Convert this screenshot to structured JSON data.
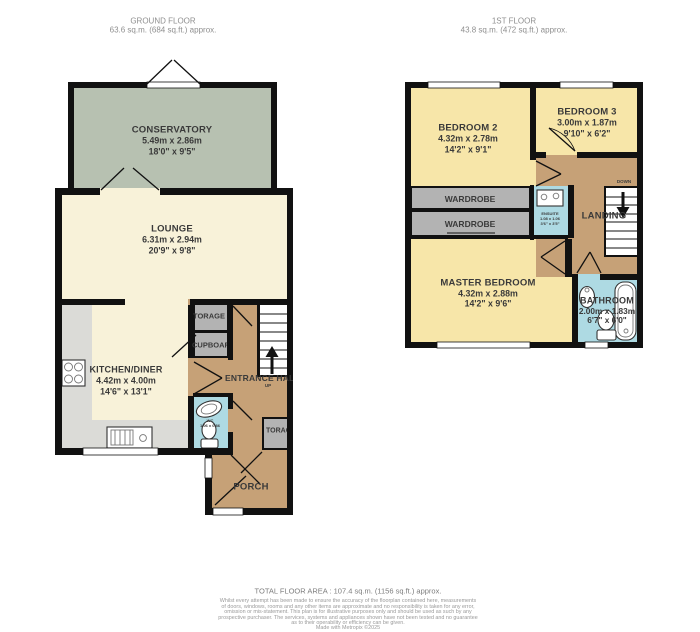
{
  "ground": {
    "header": {
      "title": "GROUND FLOOR",
      "area": "63.6 sq.m. (684 sq.ft.) approx."
    },
    "conservatory": {
      "name": "CONSERVATORY",
      "metric": "5.49m  x 2.86m",
      "imperial": "18'0\"  x 9'5\""
    },
    "lounge": {
      "name": "LOUNGE",
      "metric": "6.31m  x 2.94m",
      "imperial": "20'9\"  x 9'8\""
    },
    "kitchen": {
      "name": "KITCHEN/DINER",
      "metric": "4.42m  x 4.00m",
      "imperial": "14'6\"  x 13'1\""
    },
    "entrance_hall": {
      "name": "ENTRANCE HALL",
      "up": "UP"
    },
    "storage_top": {
      "name": "TORAGE"
    },
    "cupboard": {
      "name": "CUPBOARD"
    },
    "storage_bottom": {
      "name": "TORAG"
    },
    "wc": {
      "line1": "WC",
      "line2": "1.06 x 0.86"
    },
    "porch": {
      "name": "PORCH"
    }
  },
  "first": {
    "header": {
      "title": "1ST FLOOR",
      "area": "43.8 sq.m. (472 sq.ft.) approx."
    },
    "bedroom2": {
      "name": "BEDROOM 2",
      "metric": "4.32m  x 2.78m",
      "imperial": "14'2\"  x 9'1\""
    },
    "bedroom3": {
      "name": "BEDROOM 3",
      "metric": "3.00m  x 1.87m",
      "imperial": "9'10\"  x 6'2\""
    },
    "master": {
      "name": "MASTER BEDROOM",
      "metric": "4.32m  x 2.88m",
      "imperial": "14'2\"  x 9'6\""
    },
    "bathroom": {
      "name": "BATHROOM",
      "metric": "2.00m  x 1.83m",
      "imperial": "6'7\"  x 6'0\""
    },
    "wardrobe1": {
      "name": "WARDROBE"
    },
    "wardrobe2": {
      "name": "WARDROBE"
    },
    "landing": {
      "name": "LANDING",
      "down": "DOWN"
    },
    "ensuite": {
      "line1": "ENSUITE",
      "line2": "1.08 x 1.06",
      "line3": "3'6\" x 3'5\""
    }
  },
  "footer": {
    "total": "TOTAL FLOOR AREA : 107.4 sq.m. (1156 sq.ft.) approx.",
    "disclaimer": [
      "Whilst every attempt has been made to ensure the accuracy of the floorplan contained here, measurements",
      "of doors, windows, rooms and any other items are approximate and no responsibility is taken for any error,",
      "omission or mis-statement. This plan is for illustrative purposes only and should be used as such by any",
      "prospective purchaser. The services, systems and appliances shown have not been tested and no guarantee",
      "as to their operability or efficiency can be given."
    ],
    "credit": "Made with Metropix ©2025"
  },
  "palette": {
    "wall": "#111111",
    "cream": "#f8f2d9",
    "green": "#b7c1b1",
    "yellow": "#f7e6a9",
    "tan": "#c6a177",
    "grayroom": "#b3b3b3",
    "counter": "#dbdbd7",
    "blue": "#aedae3",
    "label": "#3a3a3a",
    "header": "#8f8f8f",
    "footer": "#9a9a9a"
  }
}
